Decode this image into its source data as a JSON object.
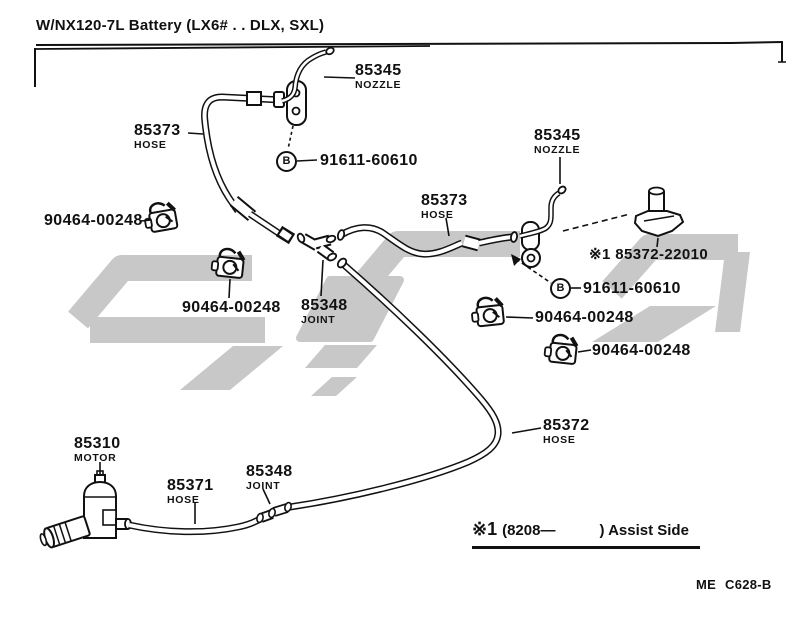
{
  "page": {
    "background": "#ffffff",
    "ink": "#111111",
    "watermark_color": "#c8c8c8"
  },
  "header": {
    "title": "W/NX120-7L Battery (LX6# . . DLX, SXL)"
  },
  "parts": {
    "nozzle_top": {
      "number": "85345",
      "name": "NOZZLE"
    },
    "hose_upper_left": {
      "number": "85373",
      "name": "HOSE"
    },
    "screw_upper": {
      "number": "91611-60610",
      "marker": "B"
    },
    "clamp_far_left": {
      "number": "90464-00248"
    },
    "clamp_mid_left": {
      "number": "90464-00248"
    },
    "joint_middle": {
      "number": "85348",
      "name": "JOINT"
    },
    "hose_middle": {
      "number": "85373",
      "name": "HOSE"
    },
    "nozzle_right": {
      "number": "85345",
      "name": "NOZZLE"
    },
    "nozzle_assist": {
      "number": "※1 85372-22010"
    },
    "screw_right": {
      "number": "91611-60610",
      "marker": "B"
    },
    "clamp_right_upper": {
      "number": "90464-00248"
    },
    "clamp_right_lower": {
      "number": "90464-00248"
    },
    "hose_rear": {
      "number": "85372",
      "name": "HOSE"
    },
    "motor": {
      "number": "85310",
      "name": "MOTOR"
    },
    "hose_front": {
      "number": "85371",
      "name": "HOSE"
    },
    "joint_front": {
      "number": "85348",
      "name": "JOINT"
    }
  },
  "footnote": {
    "ref": "※1",
    "applicability": "(8208—",
    "closing": ") Assist Side"
  },
  "doc_code": "ME  C628-B"
}
